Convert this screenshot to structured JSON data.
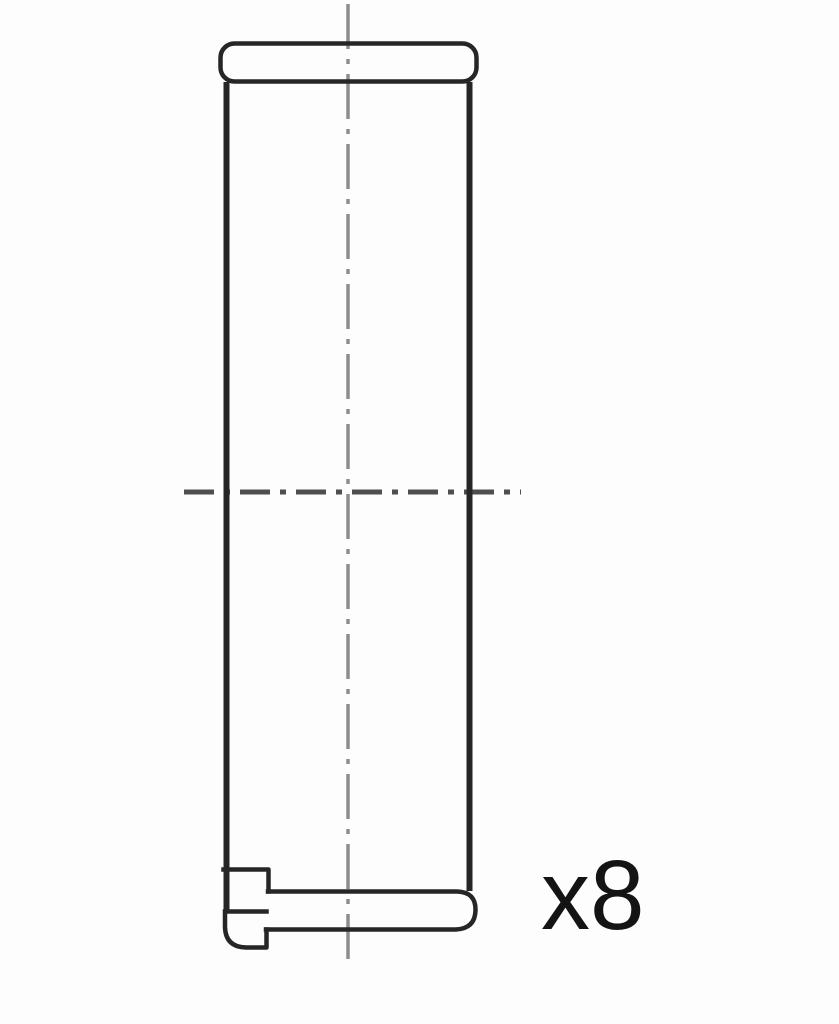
{
  "figure": {
    "quantity_label": "x8",
    "colors": {
      "outline": "#262626",
      "centerline_vertical": "#8d8d8d",
      "centerline_horizontal": "#4e4e4e",
      "text": "#141414"
    }
  }
}
